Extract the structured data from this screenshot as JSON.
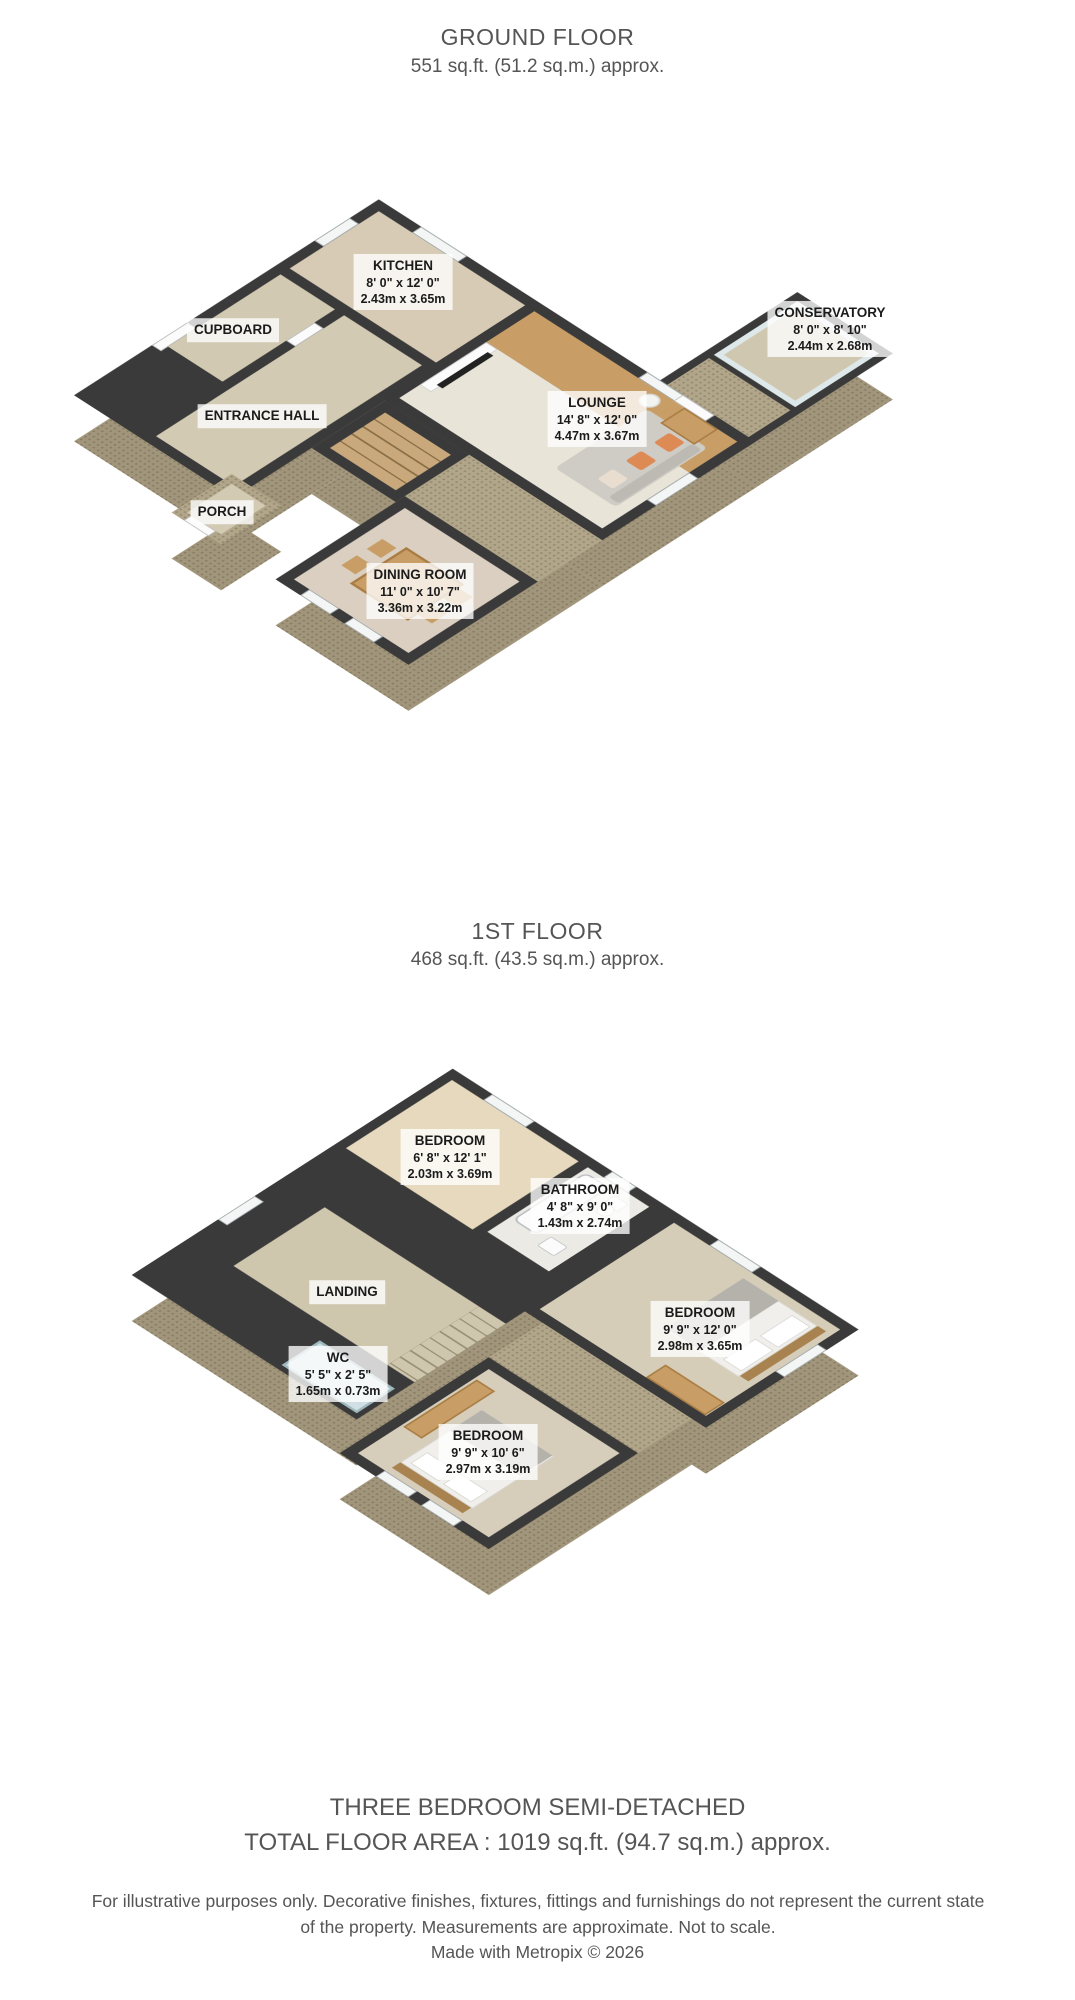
{
  "ground_floor": {
    "title": "GROUND FLOOR",
    "subtitle": "551 sq.ft. (51.2 sq.m.) approx.",
    "rooms": {
      "kitchen": {
        "name": "KITCHEN",
        "imperial": "8' 0\" x 12' 0\"",
        "metric": "2.43m x 3.65m"
      },
      "cupboard": {
        "name": "CUPBOARD",
        "imperial": "",
        "metric": ""
      },
      "entrance_hall": {
        "name": "ENTRANCE HALL",
        "imperial": "",
        "metric": ""
      },
      "porch": {
        "name": "PORCH",
        "imperial": "",
        "metric": ""
      },
      "lounge": {
        "name": "LOUNGE",
        "imperial": "14' 8\" x 12' 0\"",
        "metric": "4.47m x 3.67m"
      },
      "conservatory": {
        "name": "CONSERVATORY",
        "imperial": "8' 0\" x 8' 10\"",
        "metric": "2.44m x 2.68m"
      },
      "dining_room": {
        "name": "DINING ROOM",
        "imperial": "11' 0\" x 10' 7\"",
        "metric": "3.36m x 3.22m"
      }
    }
  },
  "first_floor": {
    "title": "1ST FLOOR",
    "subtitle": "468 sq.ft. (43.5 sq.m.) approx.",
    "rooms": {
      "bedroom_back": {
        "name": "BEDROOM",
        "imperial": "6' 8\" x 12' 1\"",
        "metric": "2.03m x 3.69m"
      },
      "bathroom": {
        "name": "BATHROOM",
        "imperial": "4' 8\" x 9' 0\"",
        "metric": "1.43m x 2.74m"
      },
      "landing": {
        "name": "LANDING",
        "imperial": "",
        "metric": ""
      },
      "wc": {
        "name": "WC",
        "imperial": "5' 5\" x 2' 5\"",
        "metric": "1.65m x 0.73m"
      },
      "bedroom_right": {
        "name": "BEDROOM",
        "imperial": "9' 9\" x 12' 0\"",
        "metric": "2.98m x 3.65m"
      },
      "bedroom_front": {
        "name": "BEDROOM",
        "imperial": "9' 9\" x 10' 6\"",
        "metric": "2.97m x 3.19m"
      }
    }
  },
  "footer": {
    "property_type": "THREE BEDROOM SEMI-DETACHED",
    "total_area": "TOTAL FLOOR AREA : 1019 sq.ft. (94.7 sq.m.) approx.",
    "disclaimer": "For illustrative purposes only. Decorative finishes, fixtures, fittings and furnishings do not represent the current state of the property. Measurements are approximate. Not to scale.",
    "credit": "Made with Metropix © 2026"
  },
  "colors": {
    "page_bg": "#ffffff",
    "wall": "#3a3a3a",
    "exterior": "#b1a68a",
    "exterior_dark": "#a1967b",
    "floor_carpet": "#d8cdbb",
    "floor_wood": "#c89e66",
    "wall_green": "#c2cfb2",
    "glass_blue": "#cfe0e4",
    "accent_cushion": "#dd8a55",
    "label_bg": "rgba(255,255,255,0.78)",
    "text": "#555555"
  }
}
